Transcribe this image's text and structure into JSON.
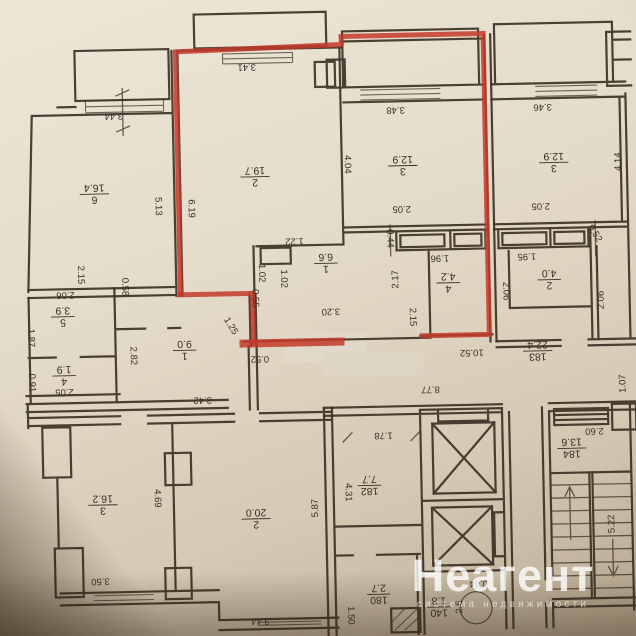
{
  "page": {
    "description": "Photographed BTI floor plan of an apartment building storey with one apartment outlined in red marker"
  },
  "highlight": {
    "color": "#c43a2c"
  },
  "watermark": {
    "title": "Неагент",
    "subtitle": "система недвижимости"
  },
  "plan": {
    "labels": [
      {
        "t": "3.44",
        "x": 118,
        "y": 112,
        "r": 180
      },
      {
        "t": "3.41",
        "x": 252,
        "y": 66,
        "r": 180
      },
      {
        "t": "3.48",
        "x": 400,
        "y": 112,
        "r": 180
      },
      {
        "t": "3.46",
        "x": 547,
        "y": 112,
        "r": 180
      },
      {
        "t": "5.13",
        "x": 161,
        "y": 203,
        "r": 90
      },
      {
        "t": "6.19",
        "x": 194,
        "y": 206,
        "r": 90
      },
      {
        "t": "4.04",
        "x": 351,
        "y": 165,
        "r": 90
      },
      {
        "t": "4.14",
        "x": 621,
        "y": 168,
        "r": 270
      },
      {
        "t": "2.05",
        "x": 404,
        "y": 211,
        "r": 180
      },
      {
        "t": "2.05",
        "x": 543,
        "y": 211,
        "r": 180
      },
      {
        "t": "2.15",
        "x": 82,
        "y": 270,
        "r": 90
      },
      {
        "t": "2.06",
        "x": 66,
        "y": 290,
        "r": 180
      },
      {
        "t": "0.58",
        "x": 126,
        "y": 283,
        "r": 90
      },
      {
        "t": "1.87",
        "x": 31,
        "y": 332,
        "r": 90
      },
      {
        "t": "0.91",
        "x": 31,
        "y": 377,
        "r": 90
      },
      {
        "t": "2.05",
        "x": 63,
        "y": 387,
        "r": 180
      },
      {
        "t": "2.82",
        "x": 133,
        "y": 352,
        "r": 90
      },
      {
        "t": "3.42",
        "x": 201,
        "y": 398,
        "r": 180
      },
      {
        "t": "1.22",
        "x": 296,
        "y": 241,
        "r": 180
      },
      {
        "t": "1.02",
        "x": 263,
        "y": 272,
        "r": 90
      },
      {
        "t": "1.02",
        "x": 285,
        "y": 278,
        "r": 90
      },
      {
        "t": "0.55",
        "x": 256,
        "y": 297,
        "r": 90
      },
      {
        "t": "3.20",
        "x": 331,
        "y": 312,
        "r": 180
      },
      {
        "t": "1.25",
        "x": 231,
        "y": 324,
        "r": 60
      },
      {
        "t": "0.52",
        "x": 259,
        "y": 358,
        "r": 180
      },
      {
        "t": "0.44",
        "x": 392,
        "y": 240,
        "r": 90
      },
      {
        "t": "2.17",
        "x": 396,
        "y": 281,
        "r": 270
      },
      {
        "t": "1.96",
        "x": 441,
        "y": 261,
        "r": 180
      },
      {
        "t": "2.15",
        "x": 413,
        "y": 319,
        "r": 90
      },
      {
        "t": "1.95",
        "x": 528,
        "y": 261,
        "r": 180
      },
      {
        "t": "0.52",
        "x": 597,
        "y": 239,
        "r": 60
      },
      {
        "t": "2.06",
        "x": 507,
        "y": 295,
        "r": 90
      },
      {
        "t": "2.06",
        "x": 601,
        "y": 306,
        "r": 270
      },
      {
        "t": "10.52",
        "x": 471,
        "y": 356,
        "r": 180
      },
      {
        "t": "8.77",
        "x": 429,
        "y": 392,
        "r": 180
      },
      {
        "t": "1.07",
        "x": 621,
        "y": 390,
        "r": 270
      },
      {
        "t": "4.69",
        "x": 154,
        "y": 495,
        "r": 90
      },
      {
        "t": "3.50",
        "x": 95,
        "y": 577,
        "r": 180
      },
      {
        "t": "5.87",
        "x": 311,
        "y": 508,
        "r": 270
      },
      {
        "t": "3.44",
        "x": 254,
        "y": 620,
        "r": 180
      },
      {
        "t": "1.78",
        "x": 381,
        "y": 437,
        "r": 180
      },
      {
        "t": "4.31",
        "x": 345,
        "y": 493,
        "r": 90
      },
      {
        "t": "2.60",
        "x": 592,
        "y": 437,
        "r": 180
      },
      {
        "t": "5.22",
        "x": 607,
        "y": 530,
        "r": 270
      },
      {
        "t": "1.50",
        "x": 345,
        "y": 616,
        "r": 90
      },
      {
        "t": "2.6",
        "x": 453,
        "y": 610,
        "r": 270
      },
      {
        "t": "0.44",
        "x": 473,
        "y": 587,
        "r": 180
      },
      {
        "t": "6",
        "t2": "16.4",
        "x": 97,
        "y": 190,
        "r": 180
      },
      {
        "t": "2",
        "t2": "19.7",
        "x": 258,
        "y": 176,
        "r": 180
      },
      {
        "t": "3",
        "t2": "12.9",
        "x": 406,
        "y": 168,
        "r": 180
      },
      {
        "t": "3",
        "t2": "12.9",
        "x": 557,
        "y": 168,
        "r": 180
      },
      {
        "t": "1",
        "t2": "6.6",
        "x": 327,
        "y": 264,
        "r": 180
      },
      {
        "t": "4",
        "t2": "4.2",
        "x": 449,
        "y": 286,
        "r": 180
      },
      {
        "t": "2",
        "t2": "4.0",
        "x": 550,
        "y": 285,
        "r": 180
      },
      {
        "t": "5",
        "t2": "3.9",
        "x": 63,
        "y": 312,
        "r": 180
      },
      {
        "t": "4",
        "t2": "1.9",
        "x": 63,
        "y": 371,
        "r": 180
      },
      {
        "t": "1",
        "t2": "9.0",
        "x": 184,
        "y": 348,
        "r": 180
      },
      {
        "t": "3",
        "t2": "16.2",
        "x": 99,
        "y": 501,
        "r": 180
      },
      {
        "t": "2",
        "t2": "20.0",
        "x": 252,
        "y": 518,
        "r": 180
      },
      {
        "t": "183",
        "t2": "22.4",
        "x": 537,
        "y": 356,
        "r": 180
      },
      {
        "t": "182",
        "t2": "7.7",
        "x": 366,
        "y": 487,
        "r": 180
      },
      {
        "t": "184",
        "t2": "13.6",
        "x": 569,
        "y": 454,
        "r": 180
      },
      {
        "t": "180",
        "t2": "2.7",
        "x": 373,
        "y": 596,
        "r": 180
      },
      {
        "t": "140",
        "t2": "1.8",
        "x": 433,
        "y": 610,
        "r": 180
      }
    ]
  }
}
